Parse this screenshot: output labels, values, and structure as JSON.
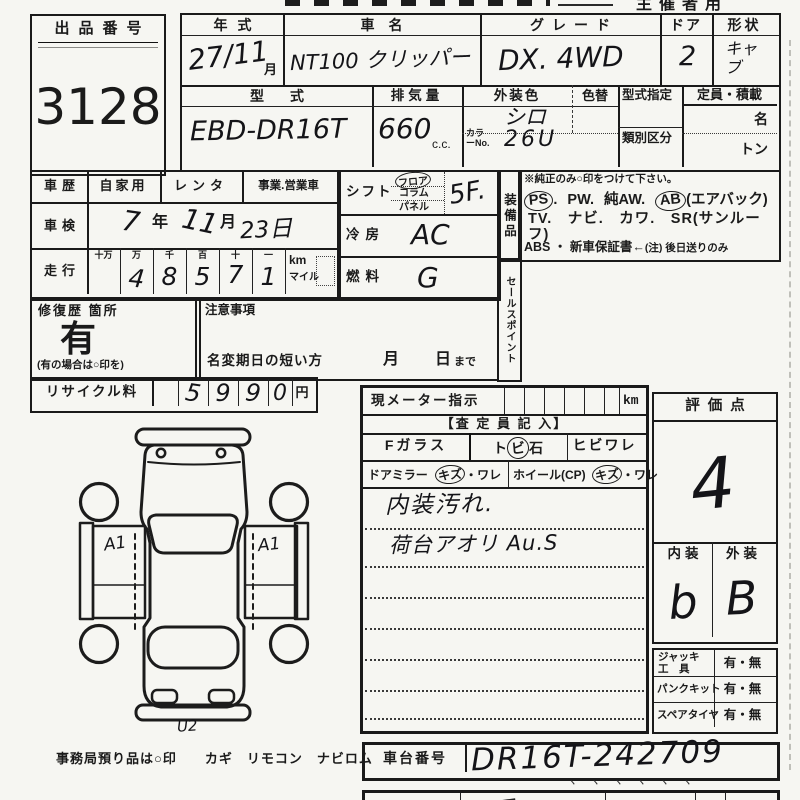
{
  "sheet": {
    "organizer_label": "主催者用",
    "office_note": "事務局預り品は○印　　カギ　リモコン　ナビロム"
  },
  "lot": {
    "label": "出品番号",
    "number": "3128"
  },
  "vehicle": {
    "year_label": "年式",
    "year_value": "27/11",
    "year_unit": "月",
    "name_label": "車名",
    "name_value": "NT100 クリッパー",
    "grade_label": "グレード",
    "grade_value": "DX. 4WD",
    "door_label": "ドア",
    "door_value": "2",
    "shape_label": "形状",
    "shape_value": "キャブ",
    "model_label": "型式",
    "model_value": "EBD-DR16T",
    "disp_label": "排気量",
    "disp_value": "660",
    "disp_unit": "c.c.",
    "color_label": "外装色",
    "color_value": "シロ",
    "color_change_label": "色替",
    "color_no_label": "カラーNo.",
    "color_no_value": "26U",
    "type_designation_label": "型式指定",
    "class_division_label": "類別区分",
    "capacity_label": "定員・積載",
    "capacity_persons_unit": "名",
    "capacity_load_unit": "トン"
  },
  "history": {
    "label": "車歴",
    "opt_private": "自家用",
    "opt_rental": "レンタ",
    "opt_business": "事業.営業車",
    "shaken_label": "車検",
    "shaken_year": "7",
    "shaken_year_unit": "年",
    "shaken_month": "11",
    "shaken_month_unit": "月",
    "shaken_day": "23日",
    "mileage_label": "走行",
    "mileage_headers": [
      "十万",
      "万",
      "千",
      "百",
      "十",
      "一"
    ],
    "mileage_digits": [
      "",
      "4",
      "8",
      "5",
      "7",
      "1"
    ],
    "mileage_unit_km": "km",
    "mileage_unit_mile": "マイル"
  },
  "specs": {
    "shift_label": "シフト",
    "shift_floor": "フロア",
    "shift_column": "コラム",
    "shift_panel": "パネル",
    "shift_value": "5F.",
    "ac_label": "冷房",
    "ac_value": "AC",
    "fuel_label": "燃料",
    "fuel_value": "G"
  },
  "equipment": {
    "vertical_label": "装備品",
    "note": "※純正のみ○印をつけて下さい。",
    "ps": "PS",
    "sep1": ".",
    "pw": "PW.",
    "aw": "純AW.",
    "ab": "AB",
    "ab_suffix": "(エアバック)",
    "line2": "TV.　ナビ.　カワ.　SR(サンルーフ)",
    "line3": "ABS ・ 新車保証書←",
    "line3_note": "(注) 後日送りのみ"
  },
  "sales_point_label": "セールスポイント",
  "repair": {
    "label": "修復歴 箇所",
    "value": "有",
    "note": "(有の場合は○印を)"
  },
  "caution": {
    "label": "注意事項",
    "rename_line": "名変期日の短い方",
    "month_unit": "月",
    "day_unit": "日",
    "until": "まで"
  },
  "recycle": {
    "label": "リサイクル料",
    "digits": [
      "5",
      "9",
      "9",
      "0"
    ],
    "unit": "円"
  },
  "inspection": {
    "meter_label": "現メーター指示",
    "meter_unit": "km",
    "section_title": "【査 定 員 記 入】",
    "glass_label": "Fガラス",
    "stone_pre": "ト",
    "stone_circled": "ビ",
    "stone_post": "石",
    "crack_label": "ヒビワレ",
    "mirror_label": "ドアミラー",
    "mirror_circled": "キズ",
    "mirror_rest": "・ワレ",
    "wheel_label": "ホイール(CP)",
    "wheel_circled": "キズ",
    "wheel_rest": "・ワレ",
    "note1": "内装汚れ.",
    "note2": "荷台アオリ Au.S"
  },
  "rating": {
    "label": "評価点",
    "value": "4",
    "interior_label": "内装",
    "interior_value": "b",
    "exterior_label": "外装",
    "exterior_value": "B"
  },
  "accessories": {
    "jack_label_1": "ジャッキ",
    "jack_label_2": "工　具",
    "jack_value": "有・無",
    "puncture_label": "パンクキット",
    "puncture_value": "有・無",
    "spare_label": "スペアタイヤ",
    "spare_value": "有・無"
  },
  "chassis": {
    "label": "車台番号",
    "value": "DR16T-242709",
    "ticks": "丶丶丶丶丶丶"
  },
  "diagram": {
    "mark_left": "A1",
    "mark_right": "A1",
    "mark_bottom": "U2"
  },
  "colors": {
    "ink": "#1a1a1a",
    "paper": "#f6f6f2"
  }
}
